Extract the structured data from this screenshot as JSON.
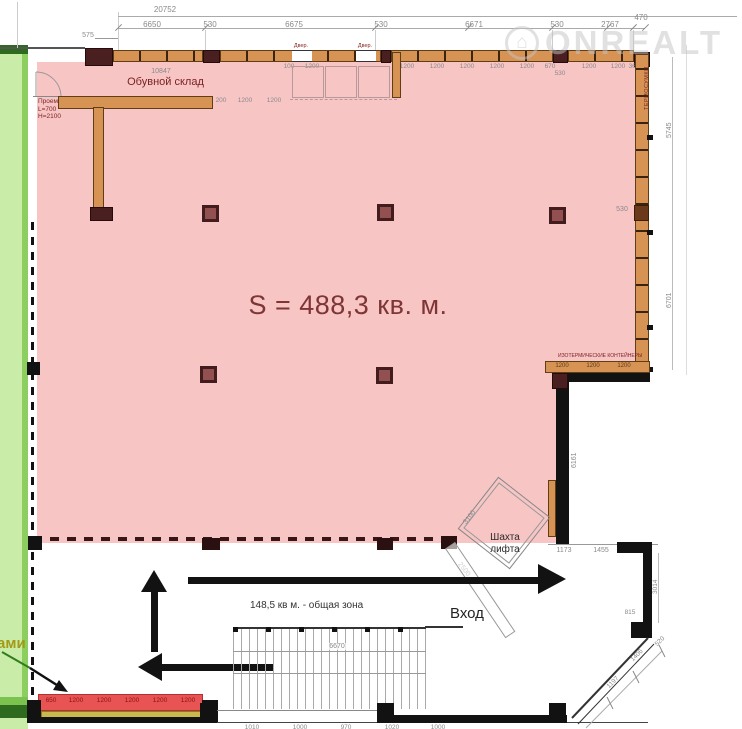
{
  "watermark": {
    "brand": "ONREALT"
  },
  "labels": {
    "main_area": "S = 488,3 кв. м.",
    "shoe_warehouse": "Обувной склад",
    "common_zone": "148,5 кв м. - общая зона",
    "entrance": "Вход",
    "elevator_line1": "Шахта",
    "elevator_line2": "лифта",
    "thermo_bags": "ТЕРМОСУМКИ",
    "iso_containers": "ИЗОТЕРМИЧЕСКИЕ КОНТЕЙНЕРЫ",
    "left_cut_word": "ами",
    "opening_line1": "Проем",
    "opening_line2": "L=700",
    "opening_line3": "H=2100",
    "door_1": "Двер.",
    "door_2": "Двер."
  },
  "dims": {
    "total_top": "20752",
    "left_offset": "575",
    "top_row": [
      "6650",
      "530",
      "6675",
      "530",
      "6671",
      "530",
      "2767",
      "470"
    ],
    "warehouse_width": "10847",
    "wall_left_pair": [
      "100",
      "1200"
    ],
    "wall_numbers_right": [
      "1200",
      "1200",
      "1200",
      "1200",
      "1200",
      "670",
      "1200",
      "1200",
      "360"
    ],
    "wall_530": "530",
    "shelf_numbers": [
      "200",
      "1200",
      "1200"
    ],
    "right_chain": [
      "5745",
      "530",
      "6701"
    ],
    "container_numbers": [
      "1200",
      "1200",
      "1200"
    ],
    "room_height": "6161",
    "shaft_side_a": "3100",
    "shaft_side_b": "2500",
    "stairs_width": "6670",
    "zone_row": [
      "1173",
      "1455",
      "1656"
    ],
    "right_lower_v": "3014",
    "right_lower_815": "815",
    "diag_520": "520",
    "diag_row": [
      "1406",
      "1197"
    ],
    "red_row": [
      "650",
      "1200",
      "1200",
      "1200",
      "1200",
      "1200"
    ],
    "bottom_row": [
      "1010",
      "1000",
      "970",
      "1020",
      "1000"
    ]
  },
  "colors": {
    "pink_zone": "#f8c5c5",
    "area_text": "#7d3535",
    "wall_tan": "#d69354",
    "block_maroon": "#4a1f1f",
    "green_strip": "#c9eda9",
    "green_dark": "#2f6b1f",
    "red_block": "#e85454",
    "yellow_strip": "#c9b84e"
  }
}
